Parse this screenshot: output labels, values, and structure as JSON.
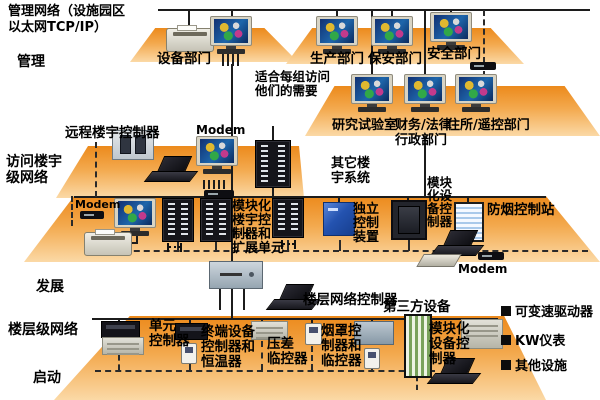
{
  "header": {
    "title": "管理网络（设施园区\n以太网TCP/IP）"
  },
  "stage_labels": {
    "management": "管理",
    "access": "访问楼宇\n级网络",
    "development": "发展",
    "floor_network": "楼层级网络",
    "startup": "启动"
  },
  "top_section": {
    "equipment_dept": "设备部门",
    "production_dept": "生产部门",
    "security_dept": "保安部门",
    "safety_dept": "安全部门",
    "note": "适合每组访问\n他们的需要",
    "research_lab": "研究试验室",
    "finance_legal": "财务/法律\n行政部门",
    "residence_remote": "住所/遥控部门"
  },
  "mid_section": {
    "remote_building_controller": "远程楼宇控制器",
    "modem_top": "Modem",
    "modem_left": "Modem",
    "modem_right": "Modem",
    "other_building_systems": "其它楼\n宇系统",
    "modular_building_controller": "模块化\n楼宇控\n制器和\n扩展单元",
    "standalone_control": "独立\n控制\n装置",
    "modular_equipment_controller": "模块\n化设\n备控\n制器",
    "smoke_control_station": "防烟控制站"
  },
  "lower_section": {
    "floor_network_controller": "楼层网络控制器",
    "third_party": "第三方设备",
    "unit_controller": "单元\n控制器",
    "terminal_controller": "终端设备\n控制器和\n恒温器",
    "pressure_monitor": "压差\n临控器",
    "hood_controller": "烟罩控\n制器和\n临控器",
    "modular_equipment_controller2": "模块化\n设备控\n制器"
  },
  "legend": {
    "items": [
      {
        "label": "可变速驱动器"
      },
      {
        "label": "KW仪表"
      },
      {
        "label": "其他设施"
      }
    ]
  }
}
